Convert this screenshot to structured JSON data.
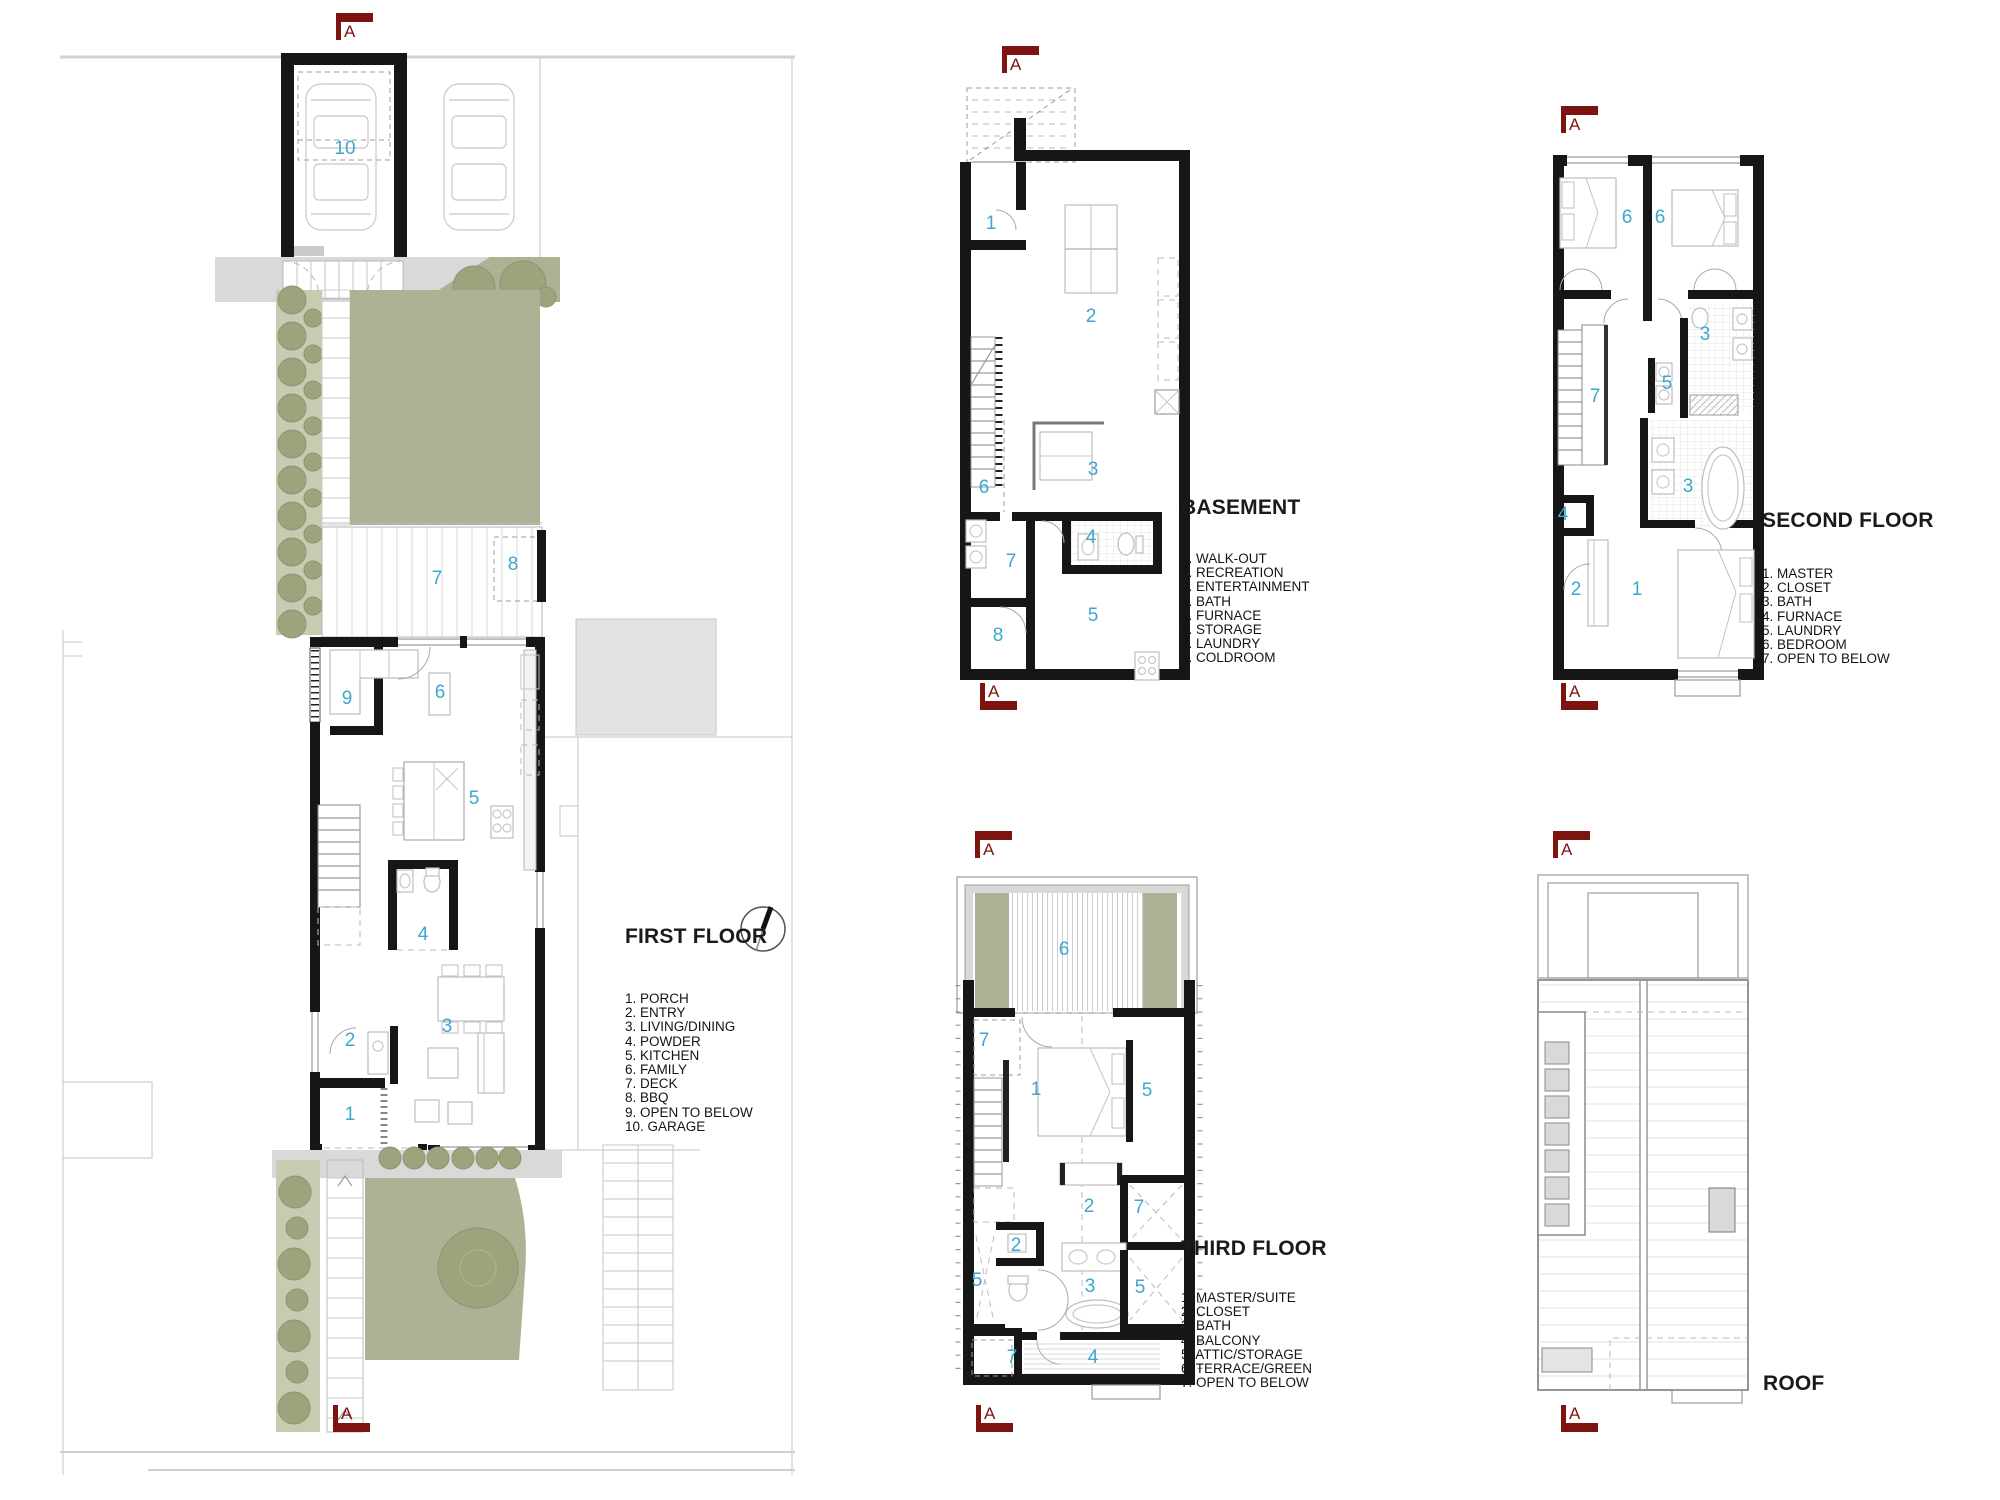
{
  "colors": {
    "section_marker": "#7e1410",
    "room_number": "#3da7cd",
    "landscape_green": "#abb394",
    "wall": "#161616",
    "paving_gray": "#d9d9d9"
  },
  "section_marker": {
    "letter": "A"
  },
  "plans": [
    {
      "id": "first-floor",
      "title": "FIRST FLOOR",
      "legend": [
        "1. PORCH",
        "2. ENTRY",
        "3. LIVING/DINING",
        "4. POWDER",
        "5. KITCHEN",
        "6. FAMILY",
        "7. DECK",
        "8. BBQ",
        "9. OPEN TO BELOW",
        "10. GARAGE"
      ],
      "room_labels": [
        {
          "n": "10",
          "x": 345,
          "y": 150
        },
        {
          "n": "7",
          "x": 437,
          "y": 580
        },
        {
          "n": "8",
          "x": 513,
          "y": 566
        },
        {
          "n": "9",
          "x": 347,
          "y": 700
        },
        {
          "n": "6",
          "x": 440,
          "y": 694
        },
        {
          "n": "5",
          "x": 474,
          "y": 800
        },
        {
          "n": "4",
          "x": 423,
          "y": 936
        },
        {
          "n": "3",
          "x": 447,
          "y": 1028
        },
        {
          "n": "2",
          "x": 350,
          "y": 1042
        },
        {
          "n": "1",
          "x": 350,
          "y": 1116
        }
      ]
    },
    {
      "id": "basement",
      "title": "BASEMENT",
      "legend": [
        "1. WALK-OUT",
        "2. RECREATION",
        "3. ENTERTAINMENT",
        "4. BATH",
        "5. FURNACE",
        "6. STORAGE",
        "7. LAUNDRY",
        "8. COLDROOM"
      ],
      "room_labels": [
        {
          "n": "1",
          "x": 991,
          "y": 225
        },
        {
          "n": "2",
          "x": 1091,
          "y": 318
        },
        {
          "n": "6",
          "x": 984,
          "y": 489
        },
        {
          "n": "3",
          "x": 1093,
          "y": 471
        },
        {
          "n": "4",
          "x": 1091,
          "y": 539
        },
        {
          "n": "7",
          "x": 1011,
          "y": 563
        },
        {
          "n": "5",
          "x": 1093,
          "y": 617
        },
        {
          "n": "8",
          "x": 998,
          "y": 637
        }
      ]
    },
    {
      "id": "second-floor",
      "title": "SECOND FLOOR",
      "legend": [
        "1. MASTER",
        "2. CLOSET",
        "3. BATH",
        "4. FURNACE",
        "5. LAUNDRY",
        "6. BEDROOM",
        "7. OPEN TO BELOW"
      ],
      "room_labels": [
        {
          "n": "6",
          "x": 1627,
          "y": 219
        },
        {
          "n": "6",
          "x": 1660,
          "y": 219
        },
        {
          "n": "3",
          "x": 1705,
          "y": 336
        },
        {
          "n": "5",
          "x": 1667,
          "y": 385
        },
        {
          "n": "7",
          "x": 1595,
          "y": 398
        },
        {
          "n": "3",
          "x": 1688,
          "y": 488
        },
        {
          "n": "4",
          "x": 1563,
          "y": 516
        },
        {
          "n": "2",
          "x": 1576,
          "y": 591
        },
        {
          "n": "1",
          "x": 1637,
          "y": 591
        }
      ]
    },
    {
      "id": "third-floor",
      "title": "THIRD FLOOR",
      "legend": [
        "1. MASTER/SUITE",
        "2. CLOSET",
        "3. BATH",
        "4. BALCONY",
        "5. ATTIC/STORAGE",
        "6. TERRACE/GREEN",
        "7. OPEN TO BELOW"
      ],
      "room_labels": [
        {
          "n": "6",
          "x": 1064,
          "y": 951
        },
        {
          "n": "7",
          "x": 984,
          "y": 1042
        },
        {
          "n": "1",
          "x": 1036,
          "y": 1091
        },
        {
          "n": "5",
          "x": 1147,
          "y": 1092
        },
        {
          "n": "2",
          "x": 1089,
          "y": 1208
        },
        {
          "n": "7",
          "x": 1139,
          "y": 1209
        },
        {
          "n": "2",
          "x": 1016,
          "y": 1247
        },
        {
          "n": "5",
          "x": 977,
          "y": 1282
        },
        {
          "n": "3",
          "x": 1090,
          "y": 1288
        },
        {
          "n": "5",
          "x": 1140,
          "y": 1289
        },
        {
          "n": "7",
          "x": 1012,
          "y": 1359
        },
        {
          "n": "4",
          "x": 1093,
          "y": 1359
        }
      ]
    },
    {
      "id": "roof",
      "title": "ROOF",
      "legend": [],
      "room_labels": []
    }
  ]
}
